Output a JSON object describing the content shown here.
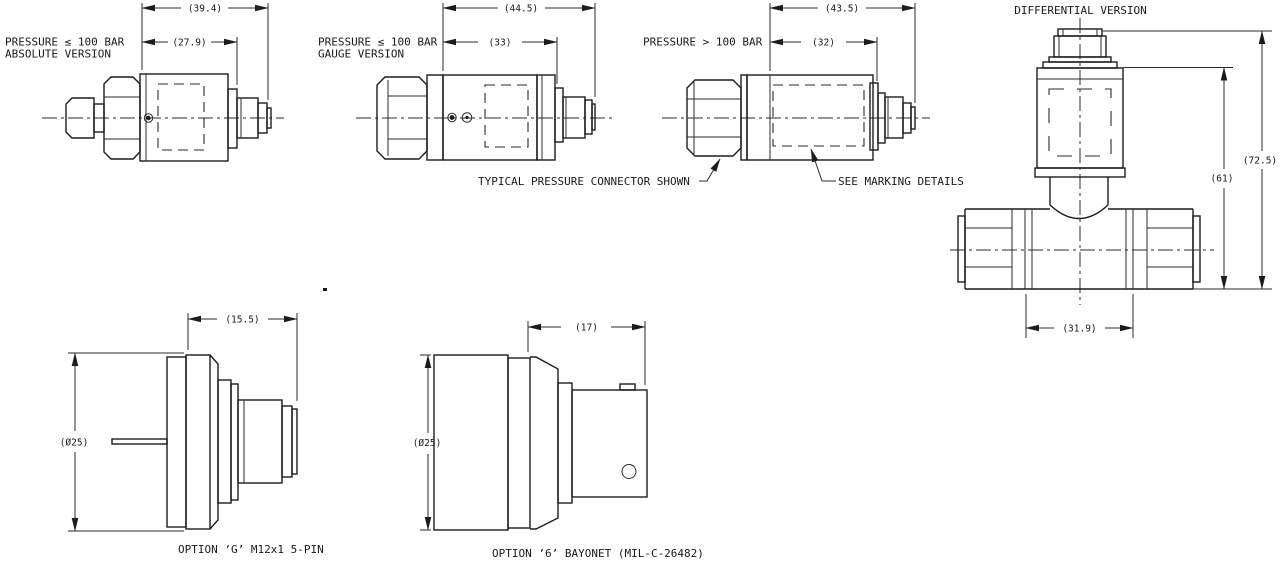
{
  "drawing": {
    "background": "#ffffff",
    "line_color": "#1c1c1c",
    "views": {
      "absolute": {
        "label_line1": "PRESSURE ≤ 100 BAR",
        "label_line2": "ABSOLUTE VERSION",
        "dim_overall": "(39.4)",
        "dim_body": "(27.9)"
      },
      "gauge": {
        "label_line1": "PRESSURE ≤ 100 BAR",
        "label_line2": "GAUGE VERSION",
        "dim_overall": "(44.5)",
        "dim_body": "(33)"
      },
      "high_pressure": {
        "label_line1": "PRESSURE > 100 BAR",
        "dim_overall": "(43.5)",
        "dim_body": "(32)"
      },
      "differential": {
        "title": "DIFFERENTIAL VERSION",
        "dim_total_height": "(72.5)",
        "dim_body_height": "(61)",
        "dim_base_width": "(31.9)"
      },
      "option_g": {
        "label": "OPTION ’G’ M12x1 5-PIN",
        "dim_depth": "(15.5)",
        "dim_diameter": "(Ø25)"
      },
      "option_6": {
        "label": "OPTION ’6’ BAYONET (MIL-C-26482)",
        "dim_depth": "(17)",
        "dim_diameter": "(Ø25)"
      }
    },
    "annotations": {
      "typical_connector": "TYPICAL PRESSURE CONNECTOR SHOWN",
      "see_marking": "SEE MARKING DETAILS"
    }
  }
}
